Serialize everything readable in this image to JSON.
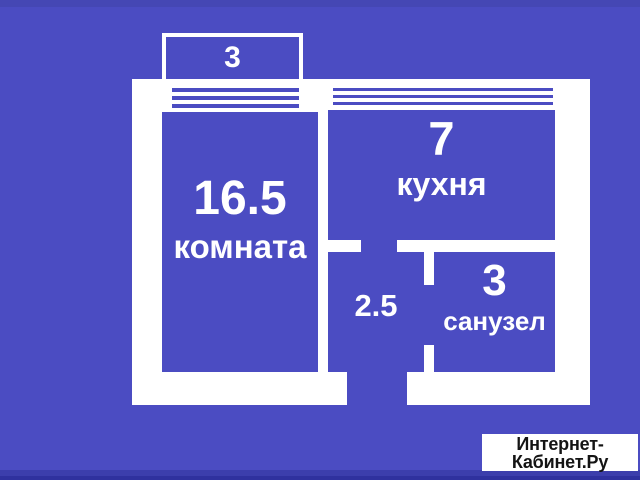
{
  "plan": {
    "balcony": {
      "area": "3"
    },
    "living_room": {
      "area": "16.5",
      "name": "комната"
    },
    "kitchen": {
      "area": "7",
      "name": "кухня"
    },
    "hallway": {
      "area": "2.5"
    },
    "bathroom": {
      "area": "3",
      "name": "санузел"
    }
  },
  "watermark": {
    "line1": "Интернет-",
    "line2": "Кабинет.Ру"
  },
  "colors": {
    "background": "#4B4CC2",
    "wall": "#FFFFFF",
    "text": "#FFFFFF",
    "watermark_bg": "#FFFFFF",
    "watermark_text": "#141414",
    "top_strip": "#4547B4",
    "bottom_strip": "#3C3EAC",
    "bottom_edge": "#2F319E"
  }
}
